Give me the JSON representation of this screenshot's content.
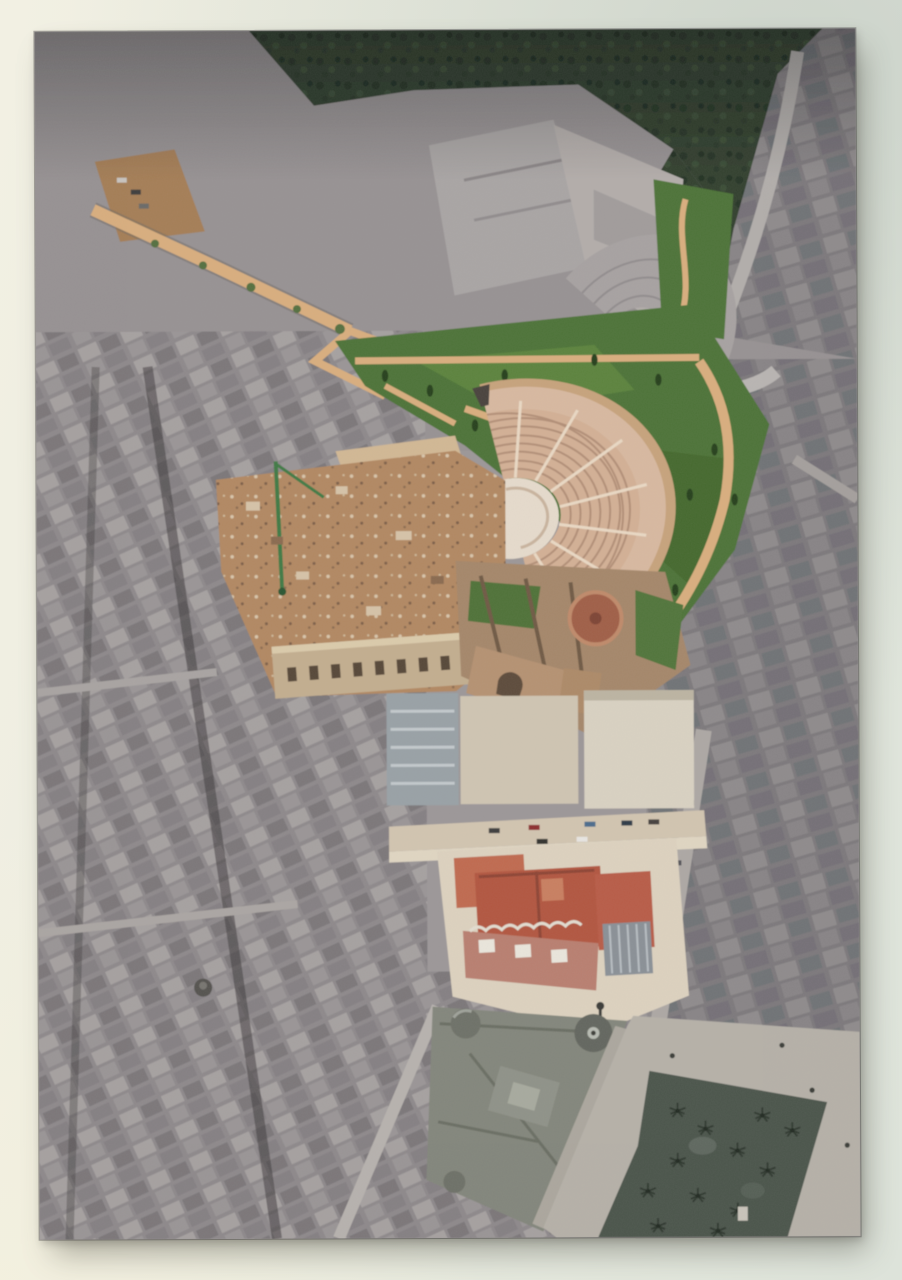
{
  "scene": {
    "type": "photograph-of-print",
    "description": "Photograph of a large aerial photo print mounted on a pale gallery wall. The aerial view shows the Roman Theatre of Cartagena and its surroundings rendered in colour - semicircular tiered cavea, excavation site with a green crane, cathedral ruins with a round brick apse, terraced gardens with cypress trees, a tan promenade path, a street with parked coloured cars and a red-roofed museum building - while the rest of the dense city, the hillside, a modern auditorium, the triangular domed city hall, the paved plaza and a dark palm grove remain greyscale.",
    "wall": {
      "label": "gallery wall"
    },
    "print": {
      "label": "aerial photo print",
      "regions": [
        {
          "id": "hillside",
          "label": "rocky hillside with scrub (greyscale)"
        },
        {
          "id": "tree-band",
          "label": "dark tree mass on hilltop"
        },
        {
          "id": "municipal-auditorium",
          "label": "modern open-air auditorium (greyscale)"
        },
        {
          "id": "hillside-parking",
          "label": "dirt parking patch with small cars"
        },
        {
          "id": "promenade-path",
          "label": "tan promenade path with trees"
        },
        {
          "id": "terraced-gardens",
          "label": "green terraced gardens with cypresses and tan ramps"
        },
        {
          "id": "roman-theatre",
          "label": "Roman theatre cavea with concentric tiers (colour)"
        },
        {
          "id": "theatre-orchestra",
          "label": "orchestra floor"
        },
        {
          "id": "theatre-stage",
          "label": "brick stage area"
        },
        {
          "id": "excavation-site",
          "label": "brown excavation site"
        },
        {
          "id": "construction-crane",
          "label": "green construction crane"
        },
        {
          "id": "ruin-facade",
          "label": "old facade with arched openings"
        },
        {
          "id": "green-netting",
          "label": "green construction netting"
        },
        {
          "id": "cathedral-ruins",
          "label": "cathedral ruins with round brick apse"
        },
        {
          "id": "street-with-cars",
          "label": "street with parked coloured cars"
        },
        {
          "id": "museum-building",
          "label": "red-roofed museum palace"
        },
        {
          "id": "city-hall",
          "label": "triangular domed city hall (greyscale)"
        },
        {
          "id": "plaza",
          "label": "paved plaza with lampposts"
        },
        {
          "id": "palm-grove",
          "label": "dark palm grove"
        },
        {
          "id": "city-left",
          "label": "dense city blocks west (greyscale)"
        },
        {
          "id": "city-right",
          "label": "city blocks east (greyscale)"
        }
      ]
    }
  },
  "palette": {
    "wall_a": "#f2f0e3",
    "wall_b": "#e9ebdf",
    "wall_c": "#dde3da",
    "print_base": "#9c9798",
    "hill": "#979293",
    "trees": "#32402f",
    "road": "#b2aeab",
    "path_tan": "#d9ae7e",
    "dirt": "#a57e56",
    "garden": "#4e7337",
    "cypress": "#263f1f",
    "theatre_fill": "#d8b9a0",
    "theatre_line": "#b28f77",
    "theatre_wall": "#c7a37c",
    "theatre_stair": "#ead9c4",
    "orchestra": "#e6dbcc",
    "stage": "#a4604a",
    "excavation": "#b28862",
    "crane": "#3f7a45",
    "ruin_facade": "#c3ae8f",
    "netting": "#3a6c31",
    "cathedral": "#a5876a",
    "apse": "#a05e46",
    "street": "#d2c5b0",
    "pavement": "#ddd2bf",
    "museum_roof": "#b25741",
    "museum_facade": "#b97f70",
    "louver": "#8a9096",
    "cityhall": "#83867c",
    "dome": "#6e7168",
    "plaza": "#b6b1a8",
    "palms": "#4b544b",
    "car_red": "#8c2f2f",
    "car_blue": "#4c6c8c"
  }
}
